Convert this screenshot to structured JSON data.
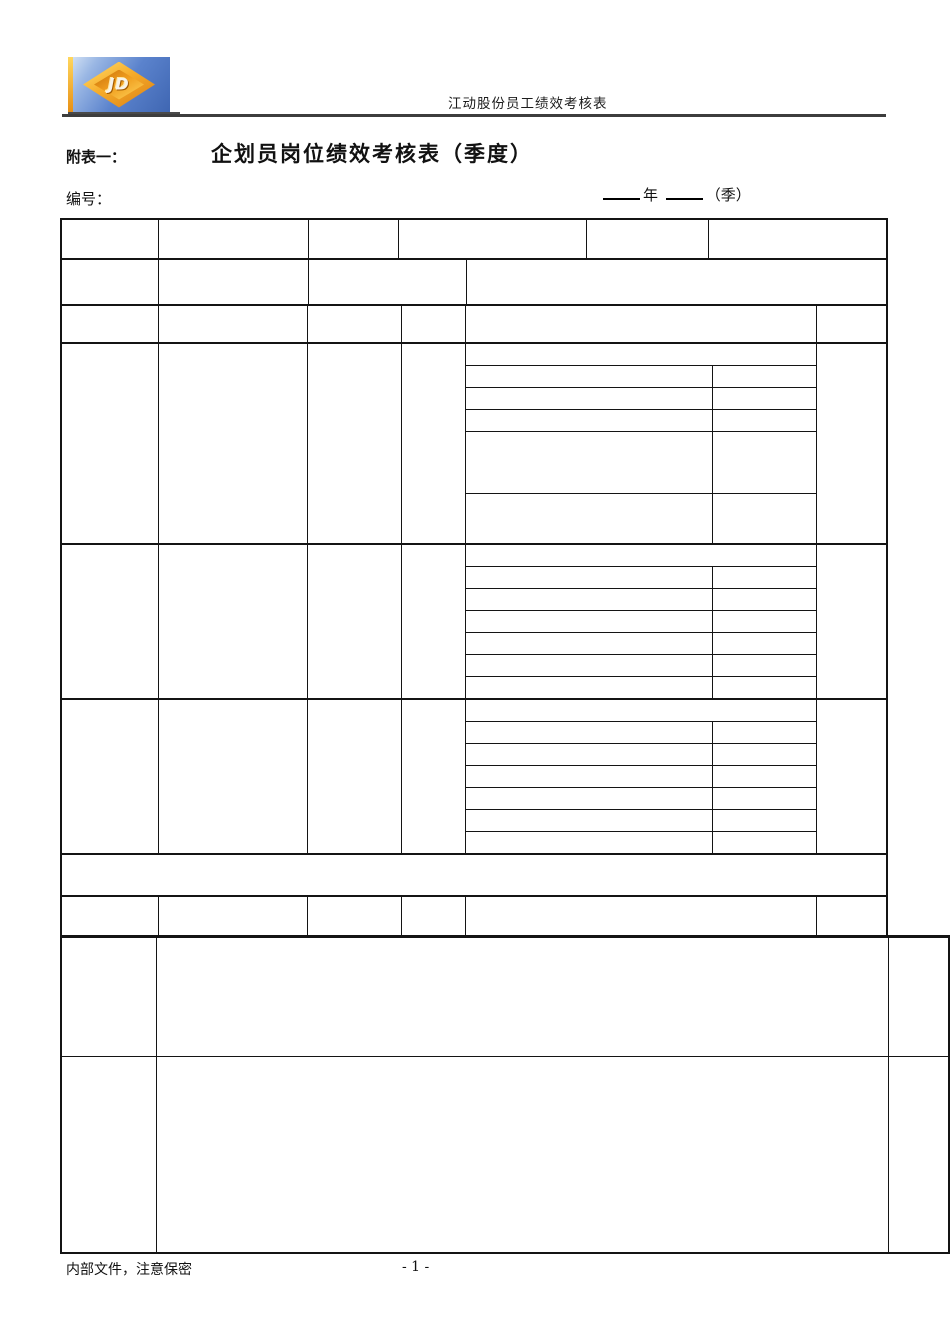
{
  "header": {
    "logo_text": "JD",
    "doc_header_text": "江动股份员工绩效考核表"
  },
  "title_block": {
    "attachment_label": "附表一：",
    "form_title": "企划员岗位绩效考核表（季度）",
    "serial_label": "编号：",
    "year_label": "年",
    "season_label": "（季）"
  },
  "footer": {
    "confidential_note": "内部文件，注意保密",
    "page_number": "- 1 -"
  },
  "colors": {
    "border": "#141414",
    "header_rule": "#3d3d3d",
    "logo_blue": "#4a74c4",
    "logo_gold": "#f2a31e"
  }
}
